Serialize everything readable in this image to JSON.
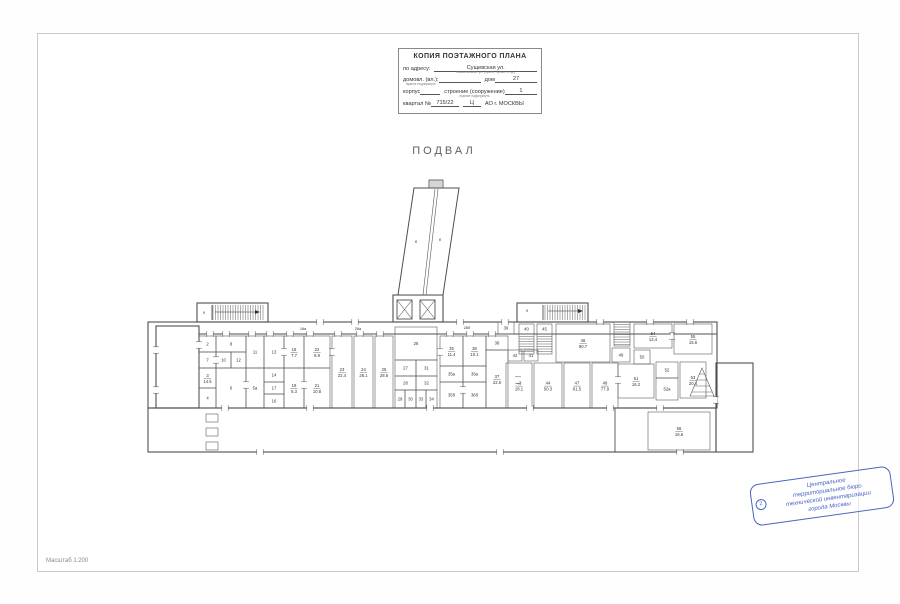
{
  "page": {
    "plan_title": "ПОДВАЛ",
    "scale_label": "Масштаб 1:200"
  },
  "title_block": {
    "header": "КОПИЯ ПОЭТАЖНОГО ПЛАНА",
    "address_label": "по адресу:",
    "address_value": "Сущевская ул.",
    "address_caption": "наименование ул. (просп., бульв. и т.д.)",
    "household_label": "домовл. (вл.):",
    "household_caption": "нужное подчеркнуть",
    "house_label": "дом",
    "house_value": "27",
    "korpus_label": "корпус",
    "stroenie_label": "строение (сооружение)",
    "stroenie_caption": "нужное подчеркнуть",
    "stroenie_value": "1",
    "kvartal_label": "квартал №",
    "kvartal_value": "715/22",
    "district_value": "Ц",
    "city_label": "АО г. МОСКВЫ"
  },
  "stamp": {
    "number": "2",
    "lines": [
      "Центральное",
      "территориальное бюро",
      "технической инвентаризации",
      "города Москвы"
    ],
    "color": "#4a63c4"
  },
  "plan": {
    "wall_color": "#4f4f4f",
    "room_color": "#5a5a5a",
    "label_color": "#333333",
    "outlines": [
      [
        148,
        322,
        569,
        86
      ],
      [
        156,
        326,
        43,
        82
      ],
      [
        148,
        408,
        568,
        44
      ],
      [
        716,
        363,
        37,
        89
      ],
      [
        197,
        303,
        71,
        19
      ],
      [
        517,
        303,
        71,
        19
      ],
      [
        393,
        295,
        50,
        27
      ]
    ],
    "extra_paths": [
      "M199,334 L717,334",
      "M615,408 L615,452",
      "M212,305 L212,320",
      "M543,305 L543,320"
    ],
    "rooms": [
      {
        "x": 199,
        "y": 336,
        "w": 17,
        "h": 16,
        "num": "2",
        "area": ""
      },
      {
        "x": 199,
        "y": 352,
        "w": 17,
        "h": 16,
        "num": "7",
        "area": ""
      },
      {
        "x": 199,
        "y": 368,
        "w": 17,
        "h": 20,
        "num": "3",
        "area": "14.5"
      },
      {
        "x": 199,
        "y": 388,
        "w": 17,
        "h": 20,
        "num": "4",
        "area": ""
      },
      {
        "x": 216,
        "y": 336,
        "w": 30,
        "h": 16,
        "num": "8",
        "area": ""
      },
      {
        "x": 216,
        "y": 352,
        "w": 15,
        "h": 16,
        "num": "10",
        "area": ""
      },
      {
        "x": 231,
        "y": 352,
        "w": 15,
        "h": 16,
        "num": "12",
        "area": ""
      },
      {
        "x": 216,
        "y": 368,
        "w": 30,
        "h": 40,
        "num": "6",
        "area": ""
      },
      {
        "x": 246,
        "y": 336,
        "w": 18,
        "h": 32,
        "num": "11",
        "area": ""
      },
      {
        "x": 246,
        "y": 368,
        "w": 18,
        "h": 40,
        "num": "5а",
        "area": ""
      },
      {
        "x": 264,
        "y": 336,
        "w": 20,
        "h": 32,
        "num": "13",
        "area": ""
      },
      {
        "x": 264,
        "y": 368,
        "w": 20,
        "h": 14,
        "num": "14",
        "area": ""
      },
      {
        "x": 264,
        "y": 382,
        "w": 20,
        "h": 12,
        "num": "17",
        "area": ""
      },
      {
        "x": 264,
        "y": 394,
        "w": 20,
        "h": 14,
        "num": "16",
        "area": ""
      },
      {
        "x": 284,
        "y": 336,
        "w": 20,
        "h": 32,
        "num": "18",
        "area": "7.7"
      },
      {
        "x": 284,
        "y": 368,
        "w": 20,
        "h": 40,
        "num": "19",
        "area": "6.3"
      },
      {
        "x": 304,
        "y": 336,
        "w": 26,
        "h": 32,
        "num": "22",
        "area": "8.9"
      },
      {
        "x": 304,
        "y": 368,
        "w": 26,
        "h": 40,
        "num": "21",
        "area": "10.8"
      },
      {
        "x": 332,
        "y": 336,
        "w": 20,
        "h": 72,
        "num": "23",
        "area": "22.4"
      },
      {
        "x": 354,
        "y": 336,
        "w": 19,
        "h": 72,
        "num": "24",
        "area": "28.1"
      },
      {
        "x": 375,
        "y": 336,
        "w": 18,
        "h": 72,
        "num": "25",
        "area": "28.6"
      },
      {
        "x": 395,
        "y": 327,
        "w": 42,
        "h": 33,
        "num": "26",
        "area": ""
      },
      {
        "x": 395,
        "y": 360,
        "w": 21,
        "h": 16,
        "num": "27",
        "area": ""
      },
      {
        "x": 416,
        "y": 360,
        "w": 21,
        "h": 16,
        "num": "31",
        "area": ""
      },
      {
        "x": 395,
        "y": 376,
        "w": 21,
        "h": 14,
        "num": "28",
        "area": ""
      },
      {
        "x": 416,
        "y": 376,
        "w": 21,
        "h": 14,
        "num": "32",
        "area": ""
      },
      {
        "x": 395,
        "y": 390,
        "w": 10,
        "h": 18,
        "num": "29",
        "area": ""
      },
      {
        "x": 405,
        "y": 390,
        "w": 11,
        "h": 18,
        "num": "30",
        "area": ""
      },
      {
        "x": 416,
        "y": 390,
        "w": 10,
        "h": 18,
        "num": "33",
        "area": ""
      },
      {
        "x": 426,
        "y": 390,
        "w": 11,
        "h": 18,
        "num": "34",
        "area": ""
      },
      {
        "x": 440,
        "y": 336,
        "w": 23,
        "h": 30,
        "num": "35",
        "area": "11.4"
      },
      {
        "x": 463,
        "y": 336,
        "w": 23,
        "h": 30,
        "num": "36",
        "area": "10.1"
      },
      {
        "x": 440,
        "y": 366,
        "w": 23,
        "h": 16,
        "num": "35а",
        "area": ""
      },
      {
        "x": 463,
        "y": 366,
        "w": 23,
        "h": 16,
        "num": "36а",
        "area": ""
      },
      {
        "x": 440,
        "y": 382,
        "w": 23,
        "h": 26,
        "num": "35б",
        "area": ""
      },
      {
        "x": 463,
        "y": 382,
        "w": 23,
        "h": 26,
        "num": "36б",
        "area": ""
      },
      {
        "x": 486,
        "y": 336,
        "w": 22,
        "h": 14,
        "num": "38",
        "area": ""
      },
      {
        "x": 486,
        "y": 350,
        "w": 22,
        "h": 58,
        "num": "37",
        "area": "22.5"
      },
      {
        "x": 498,
        "y": 322,
        "w": 16,
        "h": 12,
        "num": "39",
        "area": ""
      },
      {
        "x": 519,
        "y": 324,
        "w": 15,
        "h": 10,
        "num": "40",
        "area": ""
      },
      {
        "x": 537,
        "y": 324,
        "w": 15,
        "h": 10,
        "num": "45",
        "area": ""
      },
      {
        "x": 508,
        "y": 350,
        "w": 14,
        "h": 11,
        "num": "42",
        "area": ""
      },
      {
        "x": 524,
        "y": 350,
        "w": 14,
        "h": 11,
        "num": "41",
        "area": ""
      },
      {
        "x": 506,
        "y": 363,
        "w": 26,
        "h": 45,
        "num": "43",
        "area": "18.1"
      },
      {
        "x": 534,
        "y": 363,
        "w": 28,
        "h": 45,
        "num": "44",
        "area": "50.3"
      },
      {
        "x": 564,
        "y": 363,
        "w": 26,
        "h": 45,
        "num": "47",
        "area": "61.5"
      },
      {
        "x": 592,
        "y": 363,
        "w": 26,
        "h": 45,
        "num": "48",
        "area": "77.9"
      },
      {
        "x": 556,
        "y": 324,
        "w": 54,
        "h": 38,
        "num": "46",
        "area": "90.7"
      },
      {
        "x": 612,
        "y": 348,
        "w": 18,
        "h": 14,
        "num": "49",
        "area": ""
      },
      {
        "x": 634,
        "y": 324,
        "w": 38,
        "h": 24,
        "num": "54",
        "area": "13.4"
      },
      {
        "x": 674,
        "y": 324,
        "w": 38,
        "h": 30,
        "num": "55",
        "area": "15.6"
      },
      {
        "x": 634,
        "y": 350,
        "w": 16,
        "h": 14,
        "num": "50",
        "area": ""
      },
      {
        "x": 618,
        "y": 364,
        "w": 36,
        "h": 34,
        "num": "51",
        "area": "16.2"
      },
      {
        "x": 656,
        "y": 362,
        "w": 22,
        "h": 16,
        "num": "52",
        "area": ""
      },
      {
        "x": 656,
        "y": 378,
        "w": 22,
        "h": 22,
        "num": "52а",
        "area": ""
      },
      {
        "x": 680,
        "y": 362,
        "w": 26,
        "h": 36,
        "num": "53",
        "area": "20.4"
      },
      {
        "x": 648,
        "y": 412,
        "w": 62,
        "h": 38,
        "num": "56",
        "area": "16.6"
      }
    ],
    "free_labels": [
      {
        "x": 303,
        "y": 330,
        "t": "16а"
      },
      {
        "x": 358,
        "y": 330,
        "t": "26а"
      },
      {
        "x": 467,
        "y": 329,
        "t": "26б"
      },
      {
        "x": 204,
        "y": 314,
        "t": "9"
      },
      {
        "x": 527,
        "y": 312,
        "t": "9"
      },
      {
        "x": 416,
        "y": 243,
        "t": "б"
      },
      {
        "x": 440,
        "y": 241,
        "t": "б"
      }
    ],
    "elevators": [
      {
        "x": 397,
        "y": 300,
        "w": 15,
        "h": 19
      },
      {
        "x": 420,
        "y": 300,
        "w": 15,
        "h": 19
      }
    ],
    "ramp": {
      "body": "M398,295 L414,188 L459,188 L443,295 Z",
      "dividers": [
        "M423,295 L435,189",
        "M426,295 L438,189"
      ],
      "top_box": [
        429,
        180,
        14,
        8
      ]
    },
    "hatches": [
      {
        "x": 213,
        "y": 305,
        "w": 52,
        "h": 15,
        "step": 2.5,
        "dir": "v"
      },
      {
        "x": 545,
        "y": 305,
        "w": 42,
        "h": 15,
        "step": 2.5,
        "dir": "v"
      },
      {
        "x": 429,
        "y": 180,
        "w": 14,
        "h": 8,
        "step": 2,
        "dir": "v"
      }
    ],
    "stairs": [
      {
        "x": 519,
        "y": 334,
        "w": 15,
        "h": 20,
        "step": 2.5
      },
      {
        "x": 537,
        "y": 334,
        "w": 15,
        "h": 20,
        "step": 2.5
      },
      {
        "x": 614,
        "y": 322,
        "w": 16,
        "h": 24,
        "step": 2.5
      }
    ],
    "tri_stair": {
      "path": "M690,396 L714,396 L702,368 Z",
      "lines": [
        [
          699.5,
          374,
          704.5,
          374
        ],
        [
          697,
          380,
          707,
          380
        ],
        [
          694.5,
          386,
          709.5,
          386
        ],
        [
          692,
          392,
          712,
          392
        ]
      ]
    },
    "arrows": [
      {
        "line": [
          215,
          312,
          258,
          312
        ],
        "head": "260,312 255,310 255,314"
      },
      {
        "line": [
          548,
          311,
          581,
          311
        ],
        "head": "583,311 578,309 578,313"
      }
    ],
    "stubs": [
      [
        206,
        414,
        12,
        8
      ],
      [
        206,
        428,
        12,
        8
      ],
      [
        206,
        442,
        12,
        8
      ]
    ],
    "doors": [
      {
        "x": 210,
        "y": 334,
        "o": "h"
      },
      {
        "x": 226,
        "y": 334,
        "o": "h"
      },
      {
        "x": 252,
        "y": 334,
        "o": "h"
      },
      {
        "x": 270,
        "y": 334,
        "o": "h"
      },
      {
        "x": 290,
        "y": 334,
        "o": "h"
      },
      {
        "x": 310,
        "y": 334,
        "o": "h"
      },
      {
        "x": 338,
        "y": 334,
        "o": "h"
      },
      {
        "x": 360,
        "y": 334,
        "o": "h"
      },
      {
        "x": 380,
        "y": 334,
        "o": "h"
      },
      {
        "x": 450,
        "y": 334,
        "o": "h"
      },
      {
        "x": 470,
        "y": 334,
        "o": "h"
      },
      {
        "x": 492,
        "y": 334,
        "o": "h"
      },
      {
        "x": 320,
        "y": 322,
        "o": "h"
      },
      {
        "x": 355,
        "y": 322,
        "o": "h"
      },
      {
        "x": 460,
        "y": 322,
        "o": "h"
      },
      {
        "x": 505,
        "y": 322,
        "o": "h"
      },
      {
        "x": 600,
        "y": 322,
        "o": "h"
      },
      {
        "x": 650,
        "y": 322,
        "o": "h"
      },
      {
        "x": 690,
        "y": 322,
        "o": "h"
      },
      {
        "x": 225,
        "y": 408,
        "o": "h"
      },
      {
        "x": 310,
        "y": 408,
        "o": "h"
      },
      {
        "x": 430,
        "y": 408,
        "o": "h"
      },
      {
        "x": 530,
        "y": 408,
        "o": "h"
      },
      {
        "x": 610,
        "y": 408,
        "o": "h"
      },
      {
        "x": 660,
        "y": 408,
        "o": "h"
      },
      {
        "x": 260,
        "y": 452,
        "o": "h"
      },
      {
        "x": 500,
        "y": 452,
        "o": "h"
      },
      {
        "x": 680,
        "y": 452,
        "o": "h"
      },
      {
        "x": 199,
        "y": 345,
        "o": "v"
      },
      {
        "x": 216,
        "y": 360,
        "o": "v"
      },
      {
        "x": 246,
        "y": 385,
        "o": "v"
      },
      {
        "x": 284,
        "y": 352,
        "o": "v"
      },
      {
        "x": 304,
        "y": 385,
        "o": "v"
      },
      {
        "x": 332,
        "y": 352,
        "o": "v"
      },
      {
        "x": 440,
        "y": 352,
        "o": "v"
      },
      {
        "x": 463,
        "y": 390,
        "o": "v"
      },
      {
        "x": 518,
        "y": 380,
        "o": "v"
      },
      {
        "x": 618,
        "y": 380,
        "o": "v"
      },
      {
        "x": 672,
        "y": 336,
        "o": "v"
      },
      {
        "x": 716,
        "y": 400,
        "o": "v"
      },
      {
        "x": 156,
        "y": 350,
        "o": "v"
      },
      {
        "x": 156,
        "y": 390,
        "o": "v"
      }
    ]
  }
}
